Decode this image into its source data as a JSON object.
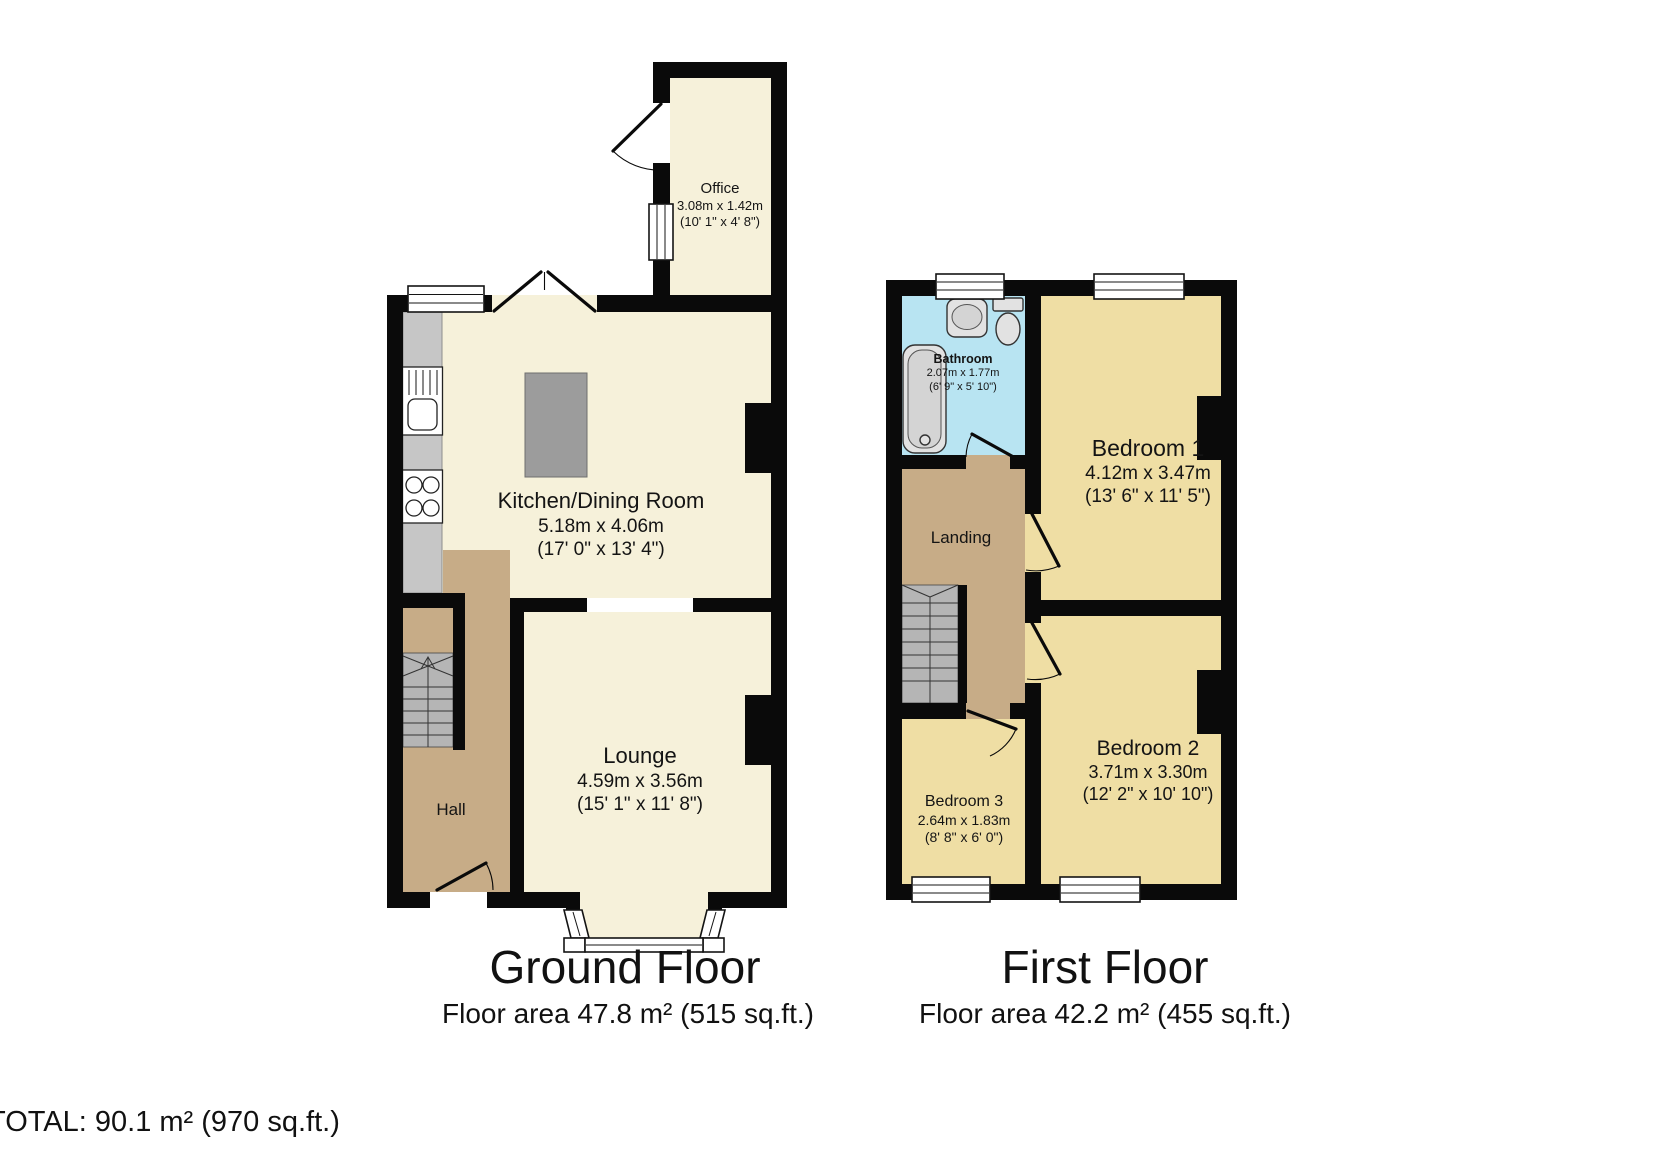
{
  "total_label": "TOTAL: 90.1 m² (970 sq.ft.)",
  "colors": {
    "wall": "#0a0a0a",
    "cream": "#f6f1da",
    "tan": "#c7ac87",
    "khaki": "#efdea4",
    "blue": "#b8e4f2"
  },
  "floors": [
    {
      "title": "Ground Floor",
      "area": "Floor area 47.8 m² (515 sq.ft.)",
      "rooms": {
        "office": {
          "name": "Office",
          "metric": "3.08m x 1.42m",
          "imperial": "(10' 1\" x 4' 8\")"
        },
        "kitchen": {
          "name": "Kitchen/Dining Room",
          "metric": "5.18m x 4.06m",
          "imperial": "(17' 0\" x 13' 4\")"
        },
        "lounge": {
          "name": "Lounge",
          "metric": "4.59m x 3.56m",
          "imperial": "(15' 1\" x 11' 8\")"
        },
        "hall": {
          "name": "Hall"
        }
      }
    },
    {
      "title": "First Floor",
      "area": "Floor area 42.2 m² (455 sq.ft.)",
      "rooms": {
        "bathroom": {
          "name": "Bathroom",
          "metric": "2.07m x 1.77m",
          "imperial": "(6' 9\" x 5' 10\")"
        },
        "landing": {
          "name": "Landing"
        },
        "bedroom1": {
          "name": "Bedroom 1",
          "metric": "4.12m x 3.47m",
          "imperial": "(13' 6\" x 11' 5\")"
        },
        "bedroom2": {
          "name": "Bedroom 2",
          "metric": "3.71m x 3.30m",
          "imperial": "(12' 2\" x 10' 10\")"
        },
        "bedroom3": {
          "name": "Bedroom 3",
          "metric": "2.64m x 1.83m",
          "imperial": "(8' 8\" x 6' 0\")"
        }
      }
    }
  ]
}
